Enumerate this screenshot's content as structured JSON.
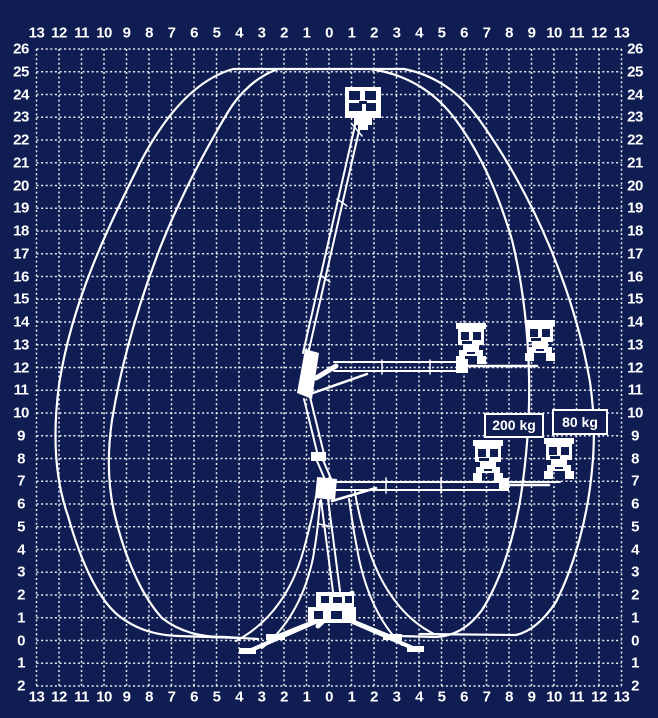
{
  "colors": {
    "background": "#101d52",
    "grid": "#ffffff",
    "figure": "#ffffff",
    "text": "#ffffff"
  },
  "axes": {
    "horizontal_labels": [
      "13",
      "12",
      "11",
      "10",
      "9",
      "8",
      "7",
      "6",
      "5",
      "4",
      "3",
      "2",
      "1",
      "0",
      "1",
      "2",
      "3",
      "4",
      "5",
      "6",
      "7",
      "8",
      "9",
      "10",
      "11",
      "12",
      "13"
    ],
    "vertical_labels": [
      "26",
      "25",
      "24",
      "23",
      "22",
      "21",
      "20",
      "19",
      "18",
      "17",
      "16",
      "15",
      "14",
      "13",
      "12",
      "11",
      "10",
      "9",
      "8",
      "7",
      "6",
      "5",
      "4",
      "3",
      "2",
      "1",
      "0",
      "1",
      "2"
    ]
  },
  "loads": [
    {
      "label": "200 kg"
    },
    {
      "label": "80 kg"
    }
  ]
}
